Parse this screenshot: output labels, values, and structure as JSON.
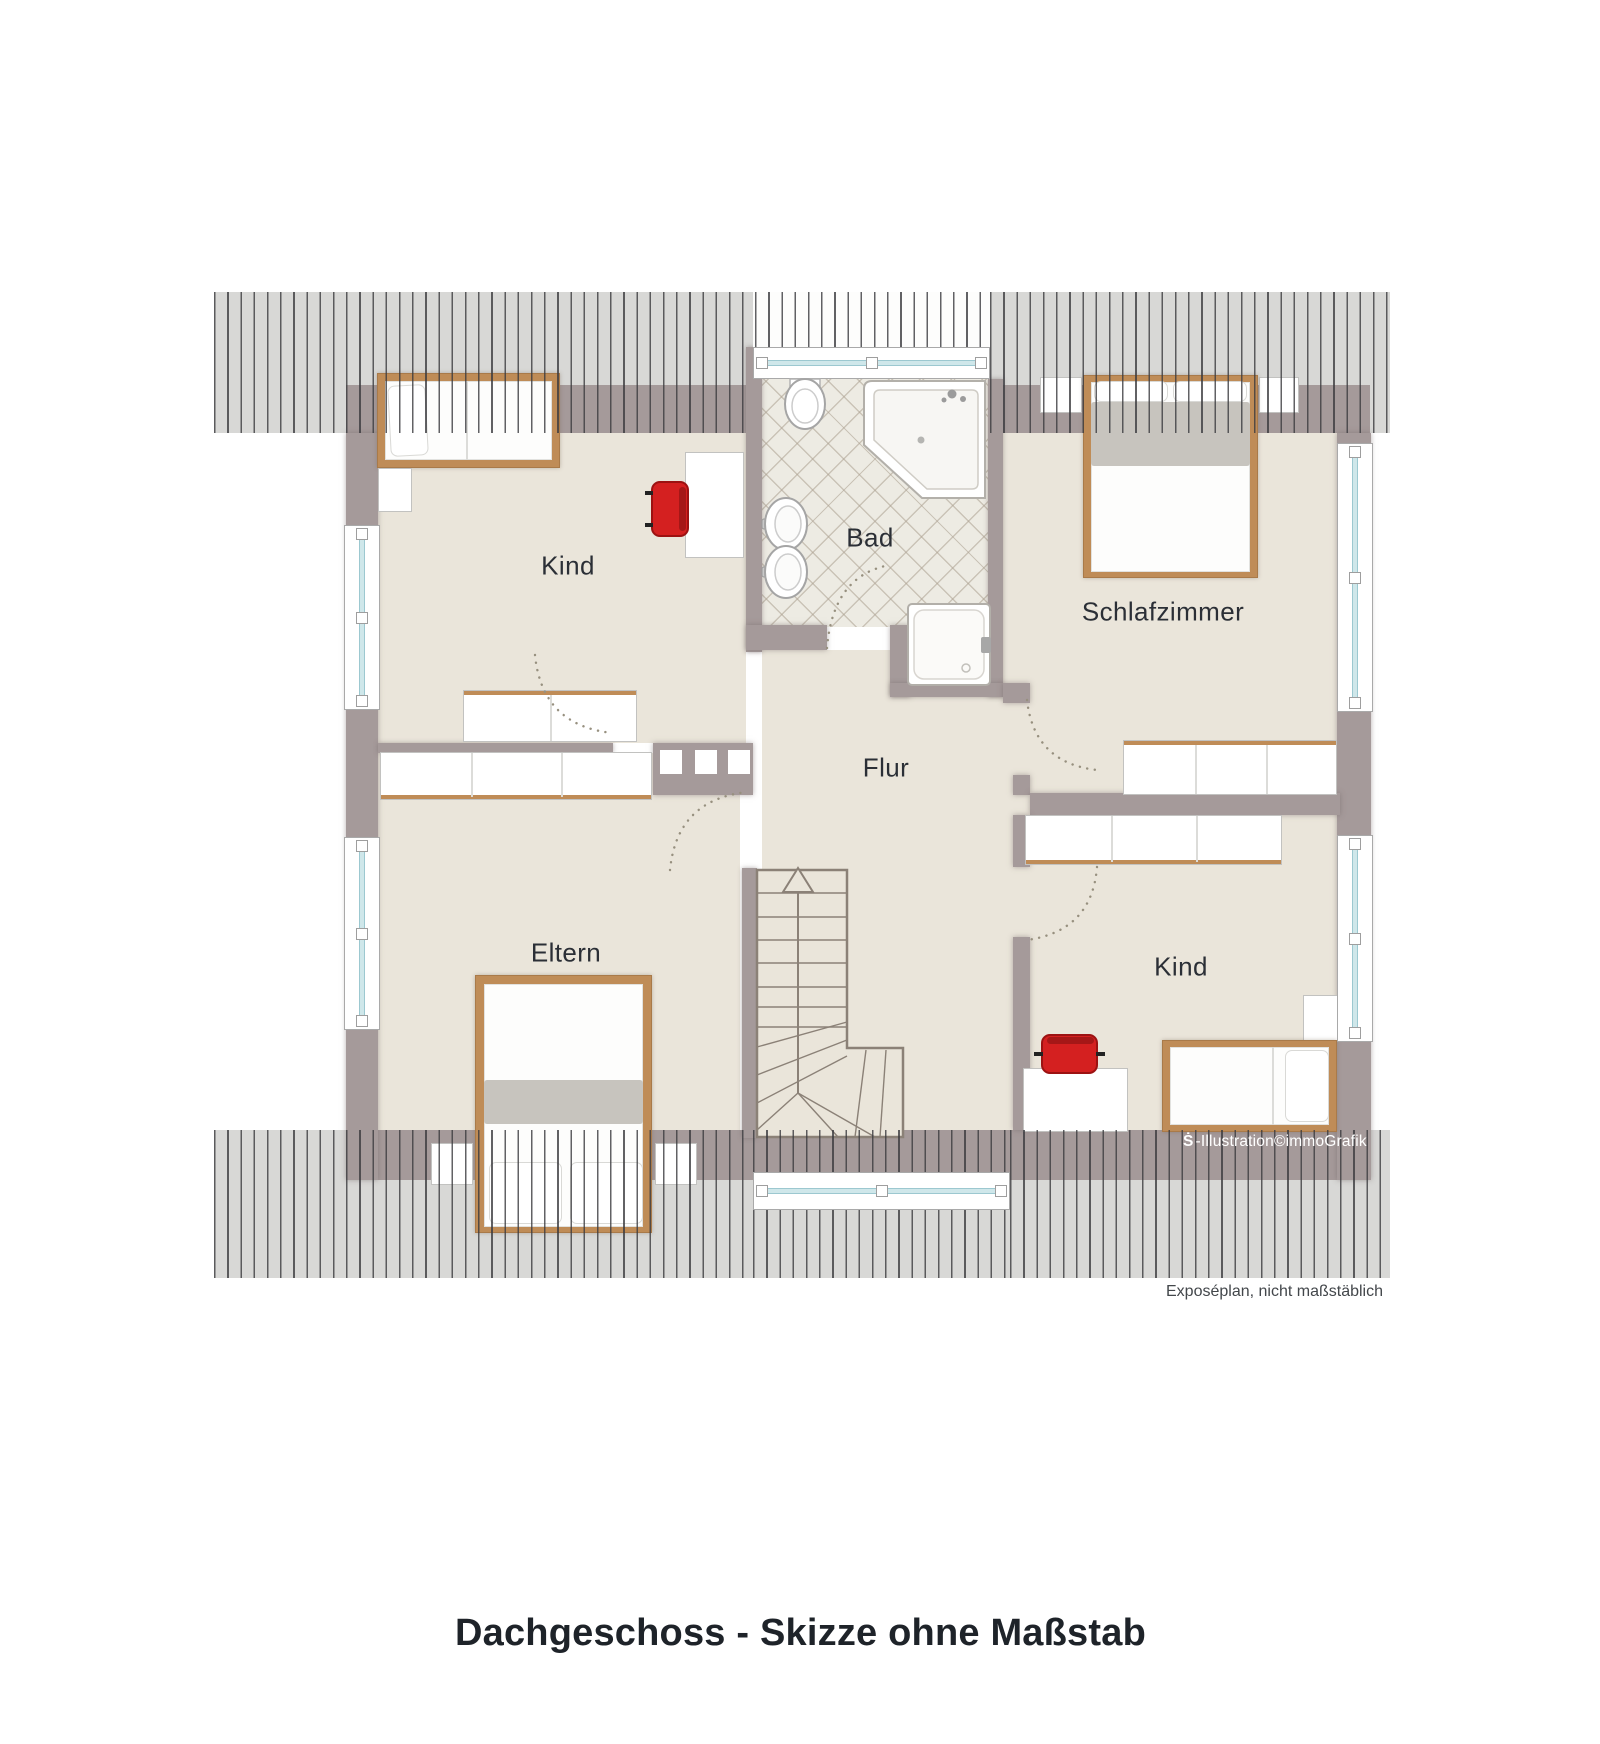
{
  "title": "Dachgeschoss - Skizze ohne Maßstab",
  "caption": "Exposéplan, nicht maßstäblich",
  "watermark": {
    "logo_glyph": "Ṡ",
    "text": "-Illustration©immoGrafik"
  },
  "rooms": {
    "kind_top_left": {
      "label": "Kind"
    },
    "bad": {
      "label": "Bad"
    },
    "schlafzimmer": {
      "label": "Schlafzimmer"
    },
    "flur": {
      "label": "Flur"
    },
    "eltern": {
      "label": "Eltern"
    },
    "kind_bottom_right": {
      "label": "Kind"
    }
  },
  "colors": {
    "wall": "#a59a9a",
    "floor": "#eae5da",
    "roof_hatch": "#d8d8d6",
    "wood_frame": "#bf8c57",
    "chair_red": "#d42020",
    "window_glass": "#cfe7ea",
    "bath_tile": "#edebe3"
  }
}
